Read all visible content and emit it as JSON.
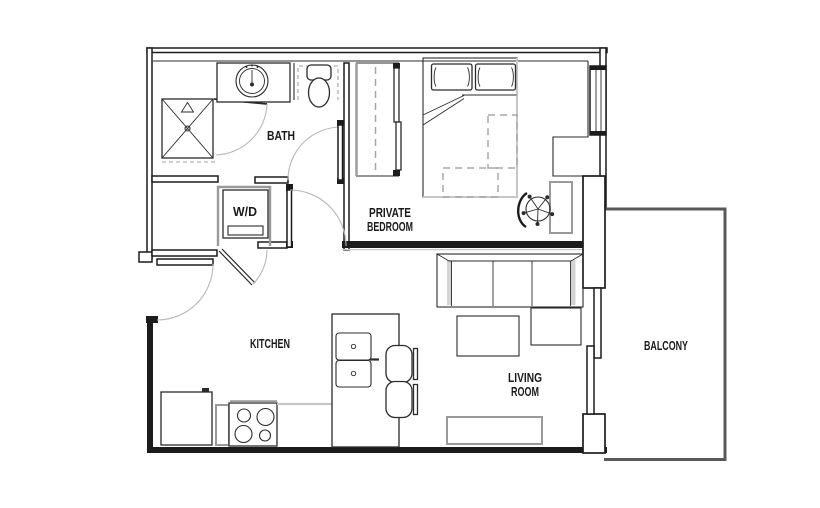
{
  "rooms": {
    "bath": {
      "label": "BATH"
    },
    "laundry": {
      "label": "W/D"
    },
    "bedroom": {
      "line1": "PRIVATE",
      "line2": "BEDROOM"
    },
    "kitchen": {
      "label": "KITCHEN"
    },
    "living": {
      "line1": "LIVING",
      "line2": "ROOM"
    },
    "balcony": {
      "label": "BALCONY"
    }
  },
  "fixtures": [
    "shower",
    "shower-door",
    "vanity-sink",
    "toilet",
    "washer-dryer",
    "laundry-door",
    "entry-door",
    "bath-door",
    "bedroom-door",
    "closet-sliding-doors",
    "bed",
    "under-bed-storage",
    "desk",
    "desk-chair",
    "bedroom-window",
    "refrigerator",
    "stove",
    "kitchen-island-sink",
    "bar-stools",
    "sofa",
    "coffee-table",
    "side-table",
    "tv-stand",
    "balcony-sliding-door"
  ],
  "colors": {
    "wall": "#1c1c1c",
    "furniture": "#2b2b2b",
    "light_gray": "#9a9a9a",
    "arc": "#b8b8b8",
    "balcony_wall": "#58595b",
    "background": "#ffffff"
  }
}
